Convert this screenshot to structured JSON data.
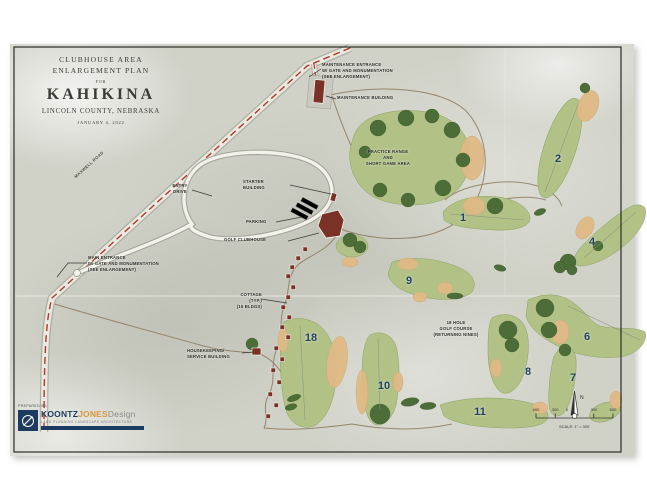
{
  "title_block": {
    "line1": "CLUBHOUSE AREA",
    "line2": "ENLARGEMENT PLAN",
    "for_text": "FOR",
    "project_name": "KAHIKINA",
    "location": "LINCOLN COUNTY, NEBRASKA",
    "date": "JANUARY 4, 2022"
  },
  "labels": {
    "maintenance_entrance": "MAINTENANCE ENTRANCE\nW/ GATE AND MONUMENTATION\n(SEE ENLARGEMENT)",
    "maintenance_building": "MAINTENANCE BUILDING",
    "practice_range": "PRACTICE RANGE\nAND\nSHORT GAME AREA",
    "entry_drive": "ENTRY\nDRIVE",
    "starter_building": "STARTER\nBUILDING",
    "parking": "PARKING",
    "golf_clubhouse": "GOLF CLUBHOUSE",
    "main_entrance": "MAIN ENTRANCE\nW/ GATE AND MONUMENTATION\n(SEE ENLARGEMENT)",
    "cottage": "COTTAGE\n(TYP.)\n(15 BLDGS)",
    "housekeeping": "HOUSEKEEPING/\nSERVICE BUILDING",
    "course_note": "18 HOLE\nGOLF COURSE\n(RETURNING NINES)",
    "maxwell_road": "MAXWELL ROAD"
  },
  "hole_numbers": {
    "h1": "1",
    "h2": "2",
    "h4": "4",
    "h6": "6",
    "h7": "7",
    "h8": "8",
    "h9": "9",
    "h10": "10",
    "h11": "11",
    "h18": "18"
  },
  "scale_bar": {
    "ticks": [
      "600",
      "300",
      "0",
      "300",
      "600"
    ],
    "north": "N",
    "caption": "SCALE: 1\" = 300'"
  },
  "logo": {
    "prepared_by": "PREPARED BY:",
    "koontz": "KOONTZ",
    "jones": "JONES",
    "design": "Design",
    "tagline": "LAND PLANNING  LANDSCAPE ARCHITECTURE"
  },
  "colors": {
    "fairway_green": "#b2c287",
    "tree_green": "#4d6d38",
    "bunker_tan": "#e0ba85",
    "building_red": "#7a3226",
    "road_dash_red": "#ad3a2a",
    "hole_number_navy": "#223f60",
    "logo_navy": "#1c3b5e"
  }
}
